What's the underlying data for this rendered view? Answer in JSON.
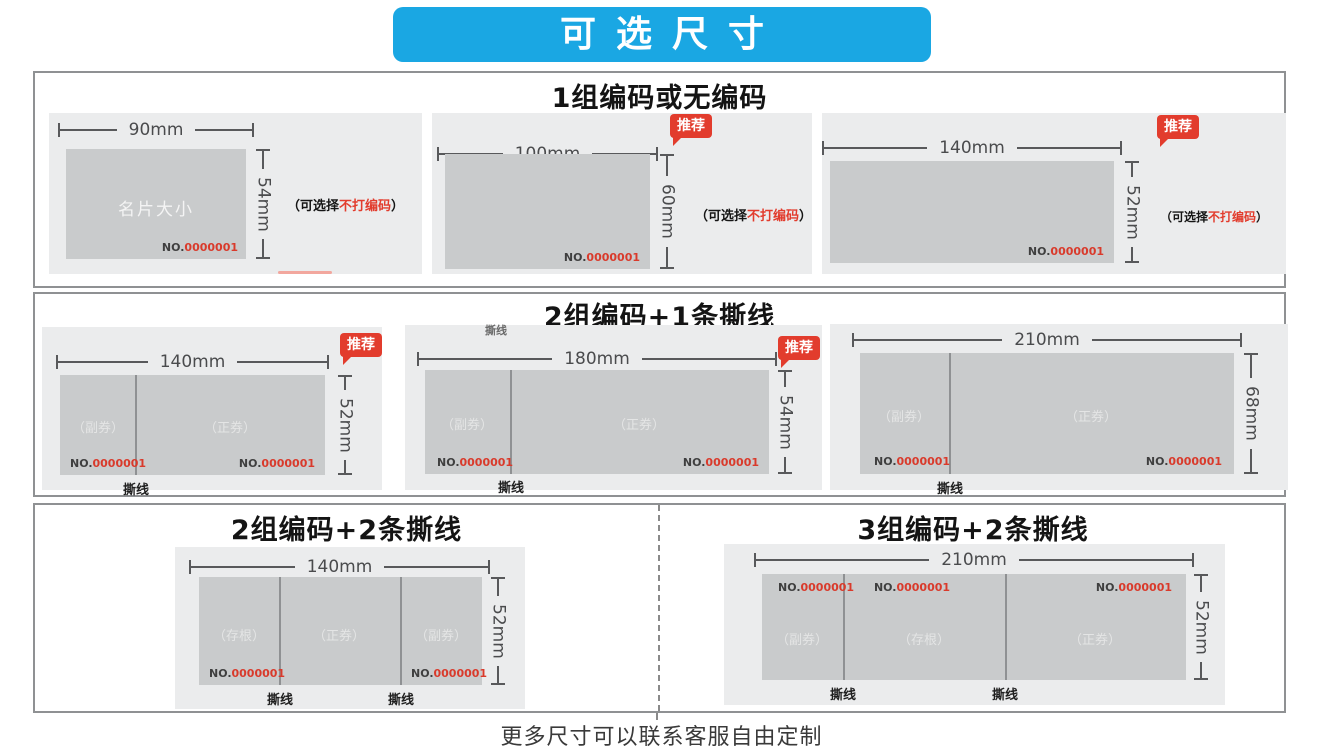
{
  "page_title": "可选尺寸",
  "caption": "更多尺寸可以联系客服自由定制",
  "labels": {
    "badge": "推荐",
    "tear": "撕线",
    "code_prefix": "NO.",
    "code_number": "0000001",
    "note_open": "（可选择",
    "note_highlight": "不打编码",
    "note_close": "）"
  },
  "colors": {
    "banner_blue": "#1aa7e3",
    "badge_red": "#e23c2d",
    "code_red": "#d93a2b",
    "card_gray": "#ebeced",
    "ticket_gray": "#c9cbcc",
    "border_gray": "#8f9193"
  },
  "sections": [
    {
      "header": "1组编码或无编码",
      "cards": [
        {
          "width_label": "90mm",
          "height_label": "54mm",
          "center_label": "名片大小",
          "recommended": false
        },
        {
          "width_label": "100mm",
          "height_label": "60mm",
          "recommended": true
        },
        {
          "width_label": "140mm",
          "height_label": "52mm",
          "recommended": true
        }
      ]
    },
    {
      "header": "2组编码+1条撕线",
      "cards": [
        {
          "width_label": "140mm",
          "height_label": "52mm",
          "recommended": true,
          "segments": [
            "（副券）",
            "（正券）"
          ]
        },
        {
          "width_label": "180mm",
          "height_label": "54mm",
          "recommended": true,
          "segments": [
            "（副券）",
            "（正券）"
          ]
        },
        {
          "width_label": "210mm",
          "height_label": "68mm",
          "recommended": false,
          "segments": [
            "（副券）",
            "（正券）"
          ]
        }
      ]
    },
    {
      "left": {
        "header": "2组编码+2条撕线",
        "card": {
          "width_label": "140mm",
          "height_label": "52mm",
          "segments": [
            "（存根）",
            "（正券）",
            "（副券）"
          ]
        }
      },
      "right": {
        "header": "3组编码+2条撕线",
        "card": {
          "width_label": "210mm",
          "height_label": "52mm",
          "segments": [
            "（副券）",
            "（存根）",
            "（正券）"
          ]
        }
      }
    }
  ]
}
